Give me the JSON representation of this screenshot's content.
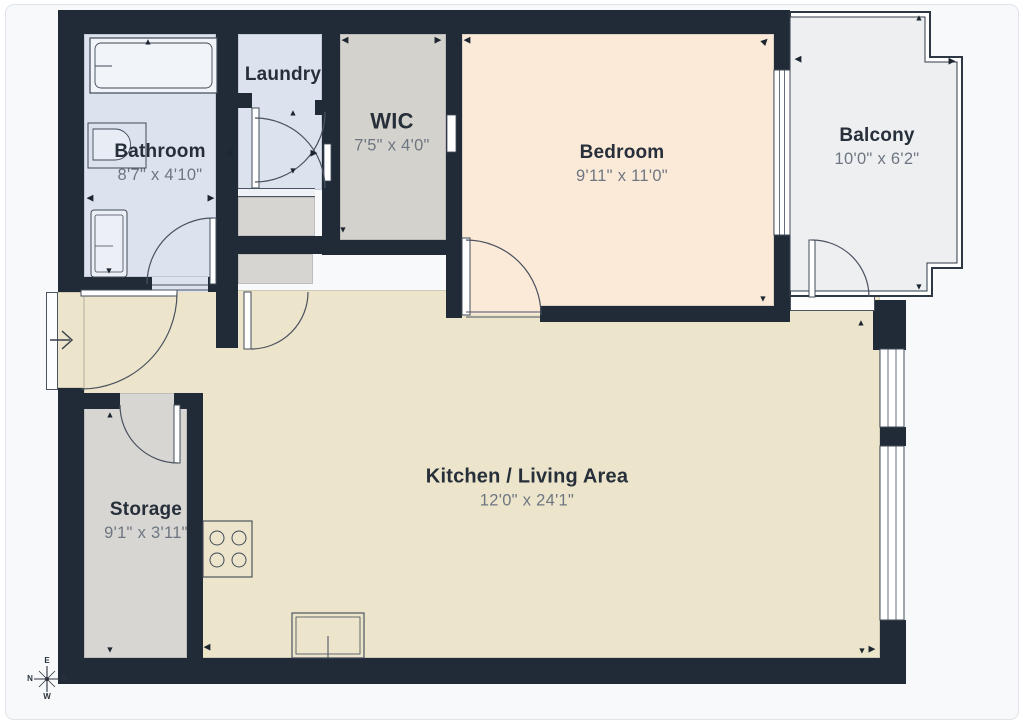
{
  "floorplan": {
    "rooms": {
      "bathroom": {
        "name": "Bathroom",
        "dims": "8'7\" x 4'10\""
      },
      "laundry": {
        "name": "Laundry"
      },
      "wic": {
        "name": "WIC",
        "dims": "7'5\" x 4'0\""
      },
      "bedroom": {
        "name": "Bedroom",
        "dims": "9'11\" x 11'0\""
      },
      "balcony": {
        "name": "Balcony",
        "dims": "10'0\" x 6'2\""
      },
      "kitchen_living": {
        "name": "Kitchen / Living Area",
        "dims": "12'0\" x 24'1\""
      },
      "storage": {
        "name": "Storage",
        "dims": "9'1\" x 3'11\""
      }
    },
    "compass": {
      "top": "E",
      "left": "N",
      "right": "S",
      "bottom": "W"
    },
    "icons": {
      "arrow_up": "▲",
      "arrow_down": "▼",
      "arrow_left": "◀",
      "arrow_right": "▶"
    },
    "colors": {
      "wall": "#212b38",
      "floor_kitchen_living": "#ece5cb",
      "floor_bedroom": "#fcead9",
      "floor_bathroom_laundry": "#dce3ee",
      "floor_hall_gray": "#d6d5d2",
      "floor_wic": "#d4d2cc",
      "floor_storage": "#d7d6d3",
      "floor_balcony": "#edeff1",
      "background": "#f7f9fa",
      "room_name_text": "#262f3a",
      "dimension_text": "#6e7681"
    }
  }
}
